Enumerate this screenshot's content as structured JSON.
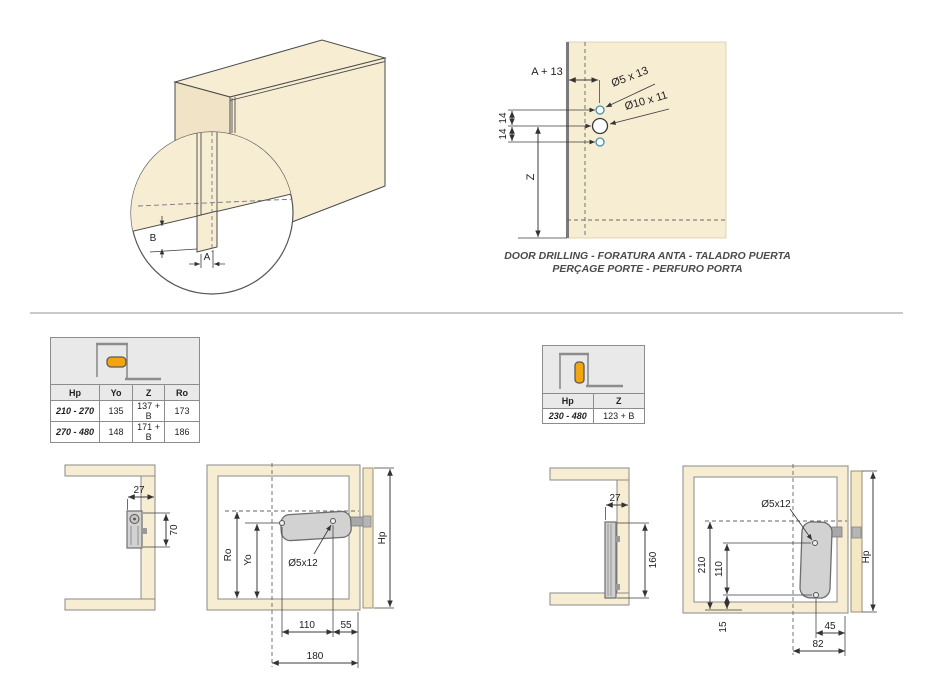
{
  "top_left_figure": {
    "dim_a": "A",
    "dim_b": "B"
  },
  "door_drilling": {
    "dim_a_plus_13": "A + 13",
    "hole_small_label": "Ø5 x 13",
    "hole_large_label": "Ø10 x 11",
    "dim_14_upper": "14",
    "dim_14_lower": "14",
    "dim_z": "Z",
    "caption_line1": "DOOR DRILLING - FORATURA ANTA - TALADRO PUERTA",
    "caption_line2": "PERÇAGE PORTE - PERFURO PORTA"
  },
  "left_section": {
    "table": {
      "headers": [
        "Hp",
        "Yo",
        "Z",
        "Ro"
      ],
      "rows": [
        [
          "210 - 270",
          "135",
          "137 + B",
          "173"
        ],
        [
          "270 - 480",
          "148",
          "171 + B",
          "186"
        ]
      ]
    },
    "side_view": {
      "dim_depth": "27",
      "dim_height": "70"
    },
    "front_view": {
      "dim_ro": "Ro",
      "dim_yo": "Yo",
      "hole_label": "Ø5x12",
      "dim_hole_spacing": "110",
      "dim_edge": "55",
      "dim_total": "180",
      "dim_hp": "Hp"
    }
  },
  "right_section": {
    "table": {
      "headers": [
        "Hp",
        "Z"
      ],
      "rows": [
        [
          "230 - 480",
          "123 + B"
        ]
      ]
    },
    "side_view": {
      "dim_depth": "27",
      "dim_height": "160"
    },
    "front_view": {
      "dim_210": "210",
      "dim_110": "110",
      "hole_label": "Ø5x12",
      "dim_15": "15",
      "dim_45": "45",
      "dim_82": "82",
      "dim_hp": "Hp"
    }
  },
  "colors": {
    "panel_beige": "#F7EDD3",
    "door_beige": "#F3E7C4",
    "mechanism_gray": "#D2D2D2",
    "accent_orange": "#F2A50C",
    "hole_teal": "#3D93AD"
  }
}
